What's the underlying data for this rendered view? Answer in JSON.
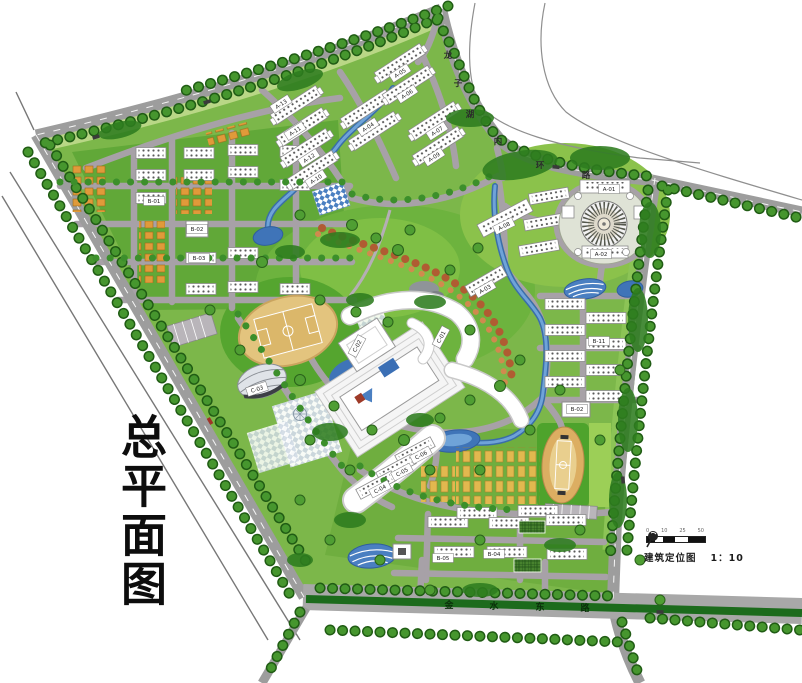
{
  "title": "总平面图",
  "legend": {
    "name": "建筑定位图",
    "scale": "1：10",
    "ticks": [
      "0",
      "10",
      "25",
      "50"
    ]
  },
  "roads": {
    "south_road_name": "金水东路",
    "south_name_chars": [
      {
        "ch": "金",
        "x": 449,
        "y": 608
      },
      {
        "ch": "水",
        "x": 494,
        "y": 609
      },
      {
        "ch": "东",
        "x": 540,
        "y": 610
      },
      {
        "ch": "路",
        "x": 585,
        "y": 611
      }
    ],
    "northeast_road_name": "龙子湖内环路",
    "ne_name_chars": [
      {
        "ch": "龙",
        "x": 448,
        "y": 58
      },
      {
        "ch": "子",
        "x": 458,
        "y": 86
      },
      {
        "ch": "湖",
        "x": 470,
        "y": 117
      },
      {
        "ch": "内",
        "x": 498,
        "y": 144
      },
      {
        "ch": "环",
        "x": 540,
        "y": 168
      },
      {
        "ch": "路",
        "x": 586,
        "y": 178
      }
    ]
  },
  "building_labels": [
    {
      "id": "A-13",
      "x": 281,
      "y": 104,
      "rot": -33
    },
    {
      "id": "A-11",
      "x": 295,
      "y": 131,
      "rot": -33
    },
    {
      "id": "A-12",
      "x": 309,
      "y": 158,
      "rot": -33
    },
    {
      "id": "A-10",
      "x": 316,
      "y": 179,
      "rot": -33
    },
    {
      "id": "A-04",
      "x": 368,
      "y": 127,
      "rot": -33
    },
    {
      "id": "A-05",
      "x": 400,
      "y": 73,
      "rot": -33
    },
    {
      "id": "A-06",
      "x": 407,
      "y": 94,
      "rot": -33
    },
    {
      "id": "A-07",
      "x": 437,
      "y": 131,
      "rot": -33
    },
    {
      "id": "A-09",
      "x": 434,
      "y": 157,
      "rot": -33
    },
    {
      "id": "A-08",
      "x": 504,
      "y": 226,
      "rot": -26
    },
    {
      "id": "A-01",
      "x": 609,
      "y": 189,
      "rot": 0
    },
    {
      "id": "A-02",
      "x": 601,
      "y": 254,
      "rot": 0
    },
    {
      "id": "A-03",
      "x": 485,
      "y": 289,
      "rot": -30
    },
    {
      "id": "B-01",
      "x": 154,
      "y": 201,
      "rot": 0
    },
    {
      "id": "B-02",
      "x": 197,
      "y": 229,
      "rot": 0
    },
    {
      "id": "B-03",
      "x": 199,
      "y": 258,
      "rot": 0
    },
    {
      "id": "B-11",
      "x": 599,
      "y": 341,
      "rot": 0
    },
    {
      "id": "B-02",
      "x": 577,
      "y": 409,
      "rot": 0
    },
    {
      "id": "B-04",
      "x": 494,
      "y": 554,
      "rot": 0
    },
    {
      "id": "B-05",
      "x": 443,
      "y": 558,
      "rot": 0
    },
    {
      "id": "C-01",
      "x": 441,
      "y": 337,
      "rot": -62
    },
    {
      "id": "C-02",
      "x": 357,
      "y": 346,
      "rot": -62
    },
    {
      "id": "C-03",
      "x": 257,
      "y": 389,
      "rot": -18
    },
    {
      "id": "C-06",
      "x": 421,
      "y": 455,
      "rot": -28
    },
    {
      "id": "C-05",
      "x": 402,
      "y": 472,
      "rot": -28
    },
    {
      "id": "C-04",
      "x": 380,
      "y": 489,
      "rot": -28
    }
  ],
  "colors": {
    "lawn": "#7cb74a",
    "dark_tree": "#2e7d1f",
    "road": "#9d9d9d",
    "internal_road": "#a7a1a7",
    "water": "#3f74b8",
    "track_tan": "#dcae62",
    "orange_building": "#e09a3a",
    "yellow_building": "#e2b84f",
    "median_green": "#1c6b1c",
    "autumn_ribbon": "#b05c32"
  }
}
